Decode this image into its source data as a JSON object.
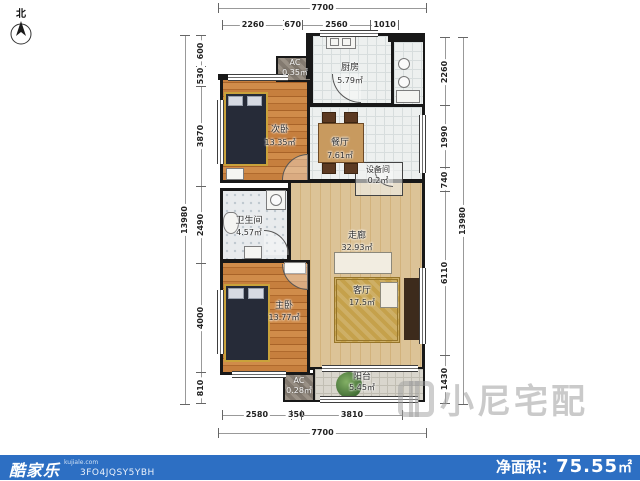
{
  "compass": {
    "label": "北"
  },
  "rooms": {
    "bedroom2": {
      "name": "次卧",
      "area": "13.35㎡"
    },
    "ac_top": {
      "name": "AC",
      "area": "0.35㎡"
    },
    "kitchen": {
      "name": "厨房",
      "area": "5.79㎡"
    },
    "dining": {
      "name": "餐厅",
      "area": "7.61㎡"
    },
    "equipment": {
      "name": "设备间",
      "area": "0.2㎡"
    },
    "bathroom": {
      "name": "卫生间",
      "area": "4.57㎡"
    },
    "hall": {
      "name": "走廊",
      "area": "32.93㎡"
    },
    "living": {
      "name": "客厅",
      "area": "17.5㎡"
    },
    "bedroom1": {
      "name": "主卧",
      "area": "13.77㎡"
    },
    "ac_bottom": {
      "name": "AC",
      "area": "0.28㎡"
    },
    "balcony": {
      "name": "阳台",
      "area": "5.45㎡"
    }
  },
  "dimensions": {
    "top": {
      "total": "7700",
      "segments": [
        "2260",
        "670",
        "2560",
        "1010"
      ]
    },
    "bottom": {
      "total": "7700",
      "segments": [
        "2580",
        "350",
        "3810"
      ]
    },
    "left": {
      "total": "13980",
      "segments": [
        "600",
        "530",
        "3870",
        "2490",
        "4000",
        "810"
      ]
    },
    "right": {
      "total": "13980",
      "segments": [
        "2260",
        "1990",
        "740",
        "6110",
        "1430"
      ]
    }
  },
  "footer": {
    "brand": "酷家乐",
    "brand_sub": "kujiale.com",
    "code": "3FO4JQSY5YBH",
    "net_area_label": "净面积：",
    "net_area_value": "75.55",
    "net_area_unit": "㎡"
  },
  "watermark": {
    "text": "小尼宅配"
  },
  "colors": {
    "footer_bar": "#2d6fc3",
    "wall": "#181818",
    "wood_floor": "#c0763a",
    "hall_floor": "#d9c196",
    "accent_gold": "#c9a23b"
  }
}
